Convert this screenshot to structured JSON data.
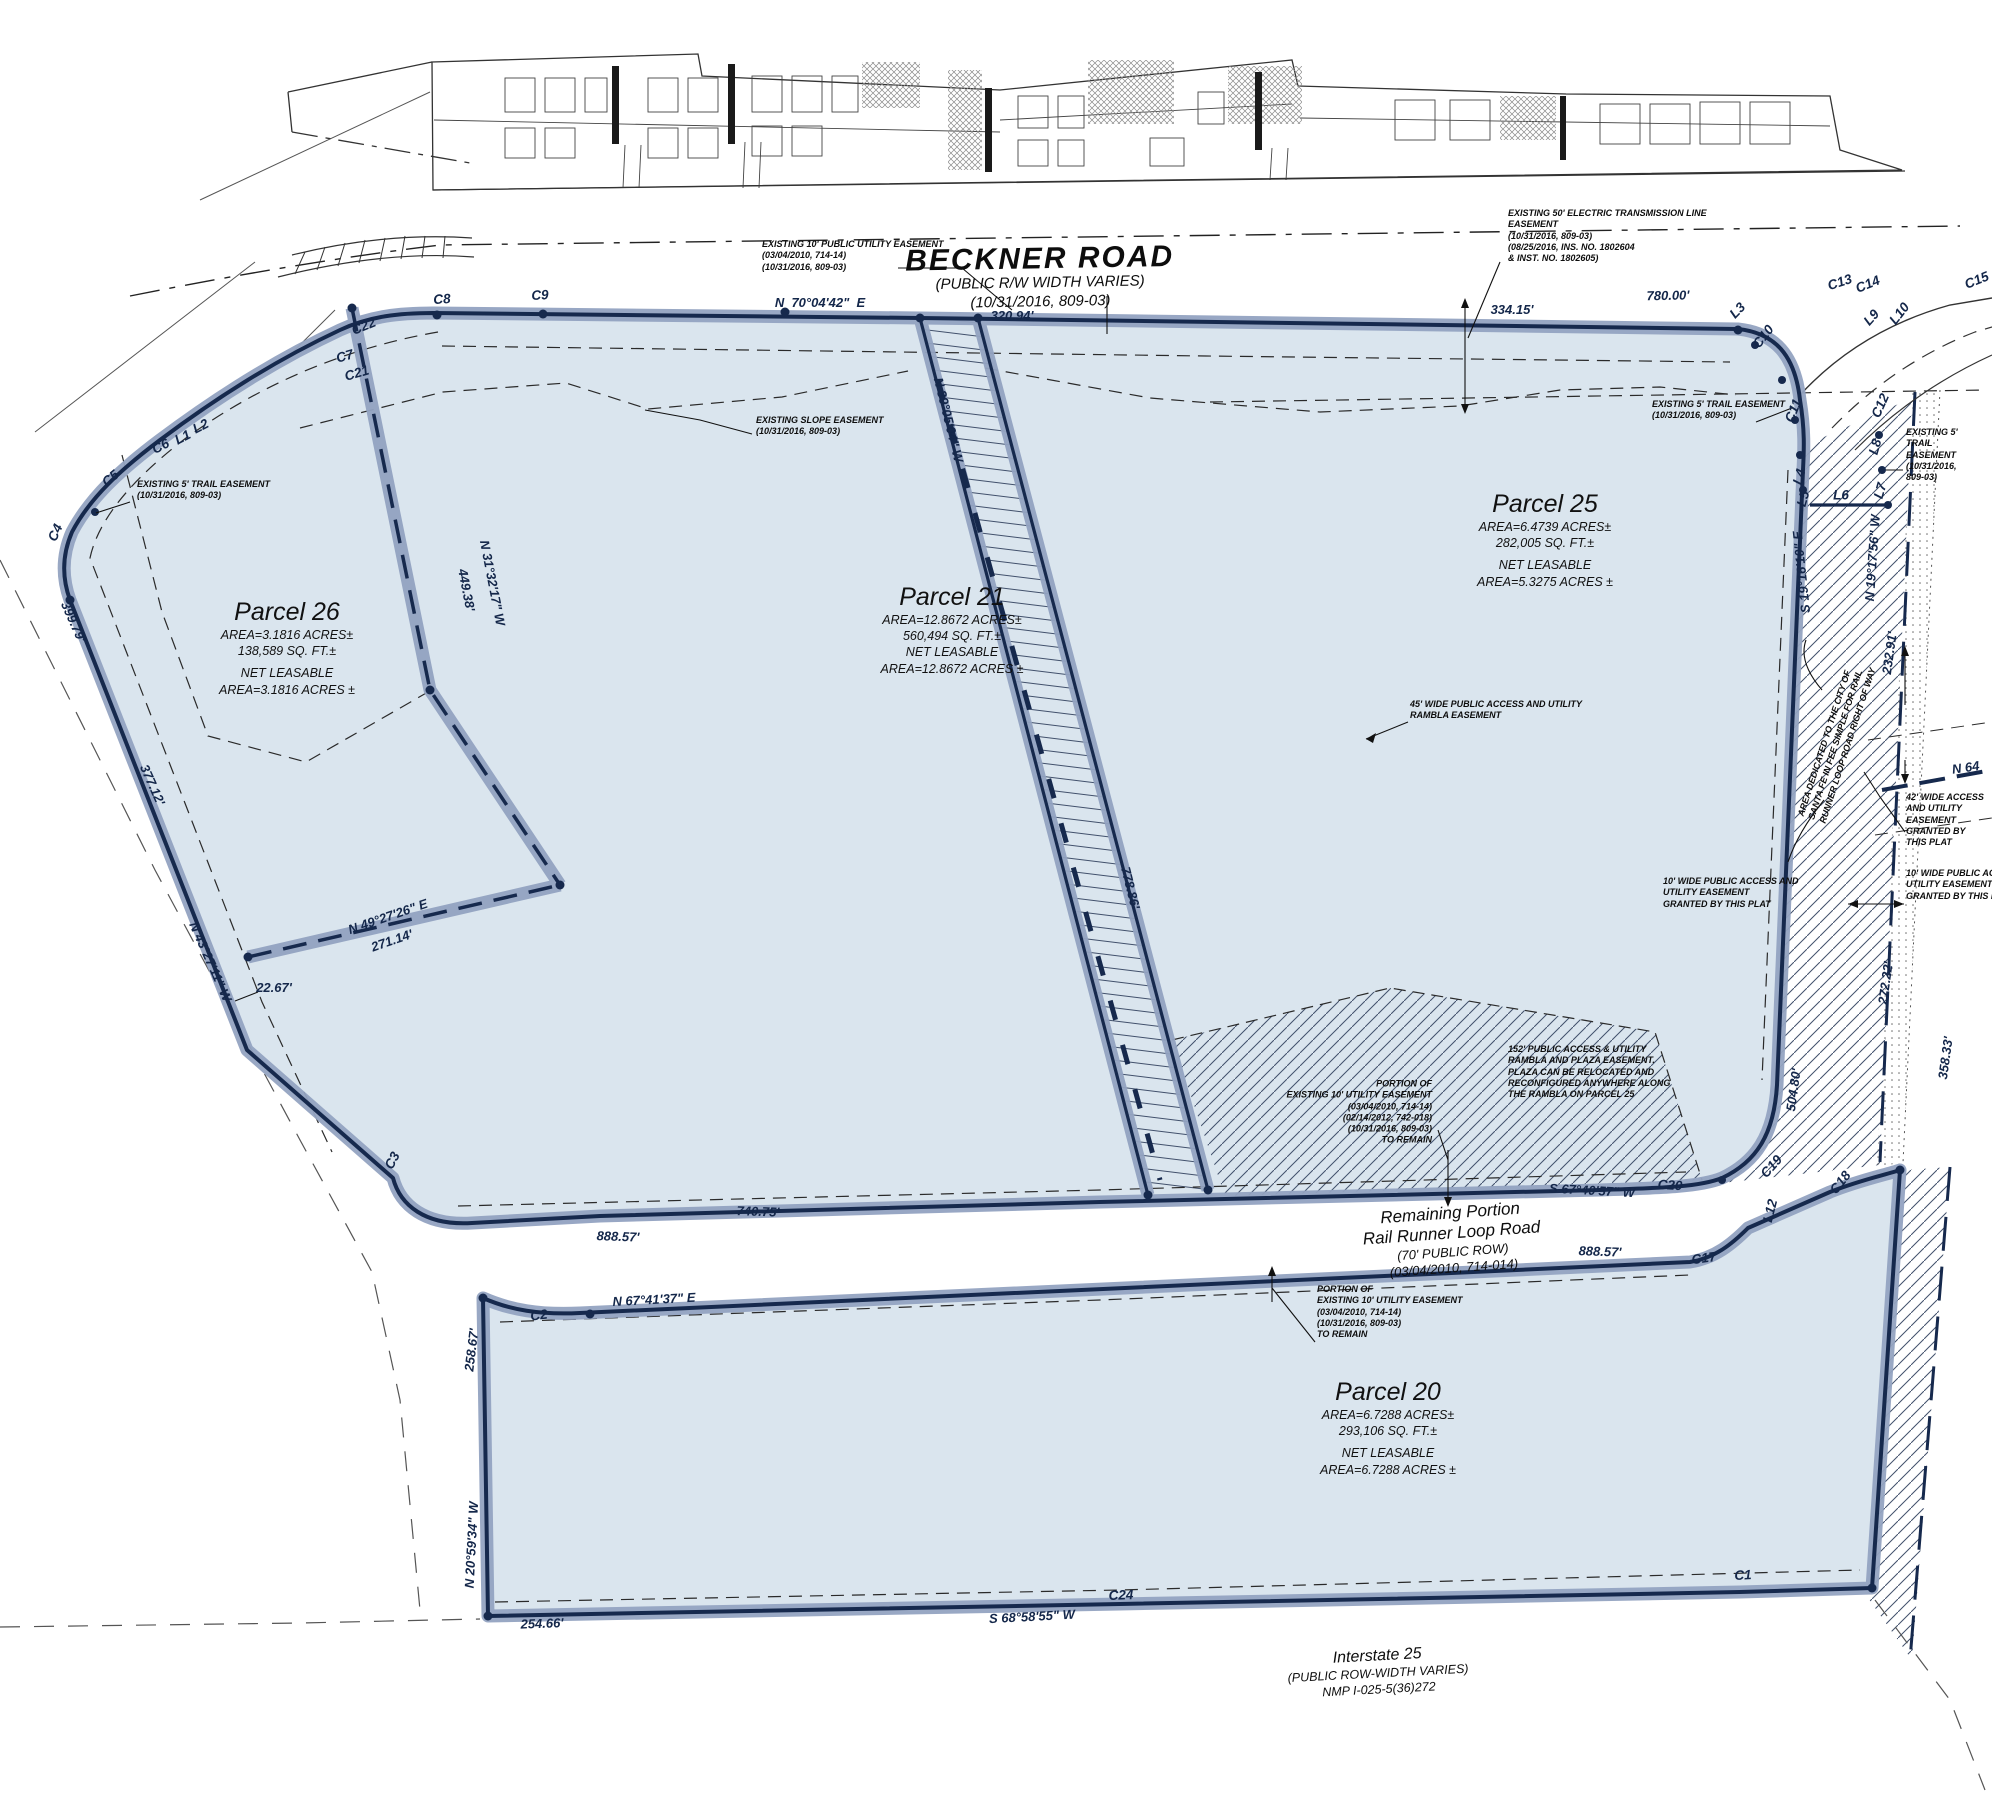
{
  "drawing_type": "subdivision plat map",
  "roads": {
    "beckner": {
      "name": "BECKNER ROAD",
      "sub1": "(PUBLIC R/W  WIDTH  VARIES)",
      "sub2": "(10/31/2016, 809-03)"
    },
    "rail_runner": {
      "line1": "Remaining Portion",
      "line2": "Rail Runner Loop Road",
      "sub1": "(70'  PUBLIC  ROW)",
      "sub2": "(03/04/2010,  714-014)"
    },
    "interstate": {
      "name": "Interstate 25",
      "sub1": "(PUBLIC ROW-WIDTH VARIES)",
      "sub2": "NMP I-025-5(36)272"
    }
  },
  "parcels": {
    "p26": {
      "title": "Parcel 26",
      "area": "AREA=3.1816  ACRES±",
      "sqft": "138,589  SQ.  FT.±",
      "net_label": "NET LEASABLE",
      "net_area": "AREA=3.1816  ACRES ±"
    },
    "p21": {
      "title": "Parcel 21",
      "area": "AREA=12.8672  ACRES±",
      "sqft": "560,494  SQ.  FT.±",
      "net_label": "NET LEASABLE",
      "net_area": "AREA=12.8672  ACRES ±"
    },
    "p25": {
      "title": "Parcel 25",
      "area": "AREA=6.4739  ACRES±",
      "sqft": "282,005  SQ.  FT.±",
      "net_label": "NET LEASABLE",
      "net_area": "AREA=5.3275  ACRES ±"
    },
    "p20": {
      "title": "Parcel 20",
      "area": "AREA=6.7288  ACRES±",
      "sqft": "293,106  SQ.  FT.±",
      "net_label": "NET LEASABLE",
      "net_area": "AREA=6.7288  ACRES ±"
    }
  },
  "colors": {
    "parcel_fill": "#dae5ee",
    "boundary_casing": "#93a3c1",
    "boundary_line": "#16294d",
    "note_text": "#0d0d0d"
  },
  "annotations": [
    {
      "name": "note-pue-beckner",
      "cls": "note",
      "align": "l",
      "x": 762,
      "y": 256,
      "rot": 0,
      "text": "EXISTING 10' PUBLIC UTILITY EASEMENT\n(03/04/2010, 714-14)\n(10/31/2016, 809-03)"
    },
    {
      "name": "note-electric-easement",
      "cls": "note",
      "align": "l",
      "x": 1508,
      "y": 236,
      "rot": 0,
      "text": "EXISTING 50' ELECTRIC TRANSMISSION LINE\nEASEMENT\n(10/31/2016, 809-03)\n(08/25/2016, INS. NO. 1802604\n& INST. NO. 1802605)"
    },
    {
      "name": "note-slope-easement",
      "cls": "note",
      "align": "l",
      "x": 756,
      "y": 426,
      "rot": 0,
      "text": "EXISTING SLOPE EASEMENT\n(10/31/2016, 809-03)"
    },
    {
      "name": "note-trail-easement-left",
      "cls": "note",
      "align": "l",
      "x": 137,
      "y": 490,
      "rot": 0,
      "text": "EXISTING 5' TRAIL EASEMENT\n(10/31/2016, 809-03)"
    },
    {
      "name": "note-trail-easement-right",
      "cls": "note",
      "align": "l",
      "x": 1652,
      "y": 410,
      "rot": 0,
      "text": "EXISTING 5' TRAIL EASEMENT\n(10/31/2016, 809-03)"
    },
    {
      "name": "note-trail-easement-right-2",
      "cls": "note",
      "align": "l",
      "x": 1906,
      "y": 455,
      "rot": 0,
      "text": "EXISTING 5'\nTRAIL\nEASEMENT\n(10/31/2016,\n809-03)"
    },
    {
      "name": "note-rambla-45",
      "cls": "note",
      "align": "l",
      "x": 1410,
      "y": 710,
      "rot": 0,
      "text": "45' WIDE PUBLIC ACCESS AND UTILITY\nRAMBLA EASEMENT"
    },
    {
      "name": "note-plaza-152",
      "cls": "note",
      "align": "l",
      "x": 1508,
      "y": 1072,
      "rot": 0,
      "text": "152' PUBLIC ACCESS & UTILITY\nRAMBLA AND PLAZA EASEMENT.\nPLAZA CAN BE RELOCATED AND\nRECONFIGURED ANYWHERE ALONG\nTHE RAMBLA ON PARCEL 25"
    },
    {
      "name": "note-10-access-and-utility",
      "cls": "note",
      "align": "l",
      "x": 1663,
      "y": 893,
      "rot": 0,
      "text": "10' WIDE PUBLIC ACCESS AND\nUTILITY EASEMENT\nGRANTED BY THIS PLAT"
    },
    {
      "name": "note-10-access-utility",
      "cls": "note",
      "align": "l",
      "x": 1906,
      "y": 885,
      "rot": 0,
      "text": "10' WIDE PUBLIC ACCESS\nUTILITY EASEMENT\nGRANTED BY THIS PLAT"
    },
    {
      "name": "note-42-access",
      "cls": "note",
      "align": "l",
      "x": 1906,
      "y": 820,
      "rot": 0,
      "text": "42' WIDE ACCESS\nAND UTILITY\nEASEMENT\nGRANTED BY\nTHIS PLAT"
    },
    {
      "name": "note-city-dedication",
      "cls": "note",
      "align": "c",
      "x": 1837,
      "y": 742,
      "rot": -72,
      "text": "AREA DEDICATED TO THE CITY OF\nSANTA FE IN FEE SIMPLE FOR RAIL\nRUNNER LOOP ROAD RIGHT OF WAY"
    },
    {
      "name": "note-portion-pue-mid",
      "cls": "note",
      "align": "r",
      "x": 1432,
      "y": 1112,
      "rot": 0,
      "text": "PORTION OF\nEXISTING 10' UTILITY EASEMENT\n(03/04/2010, 714-14)\n(02/14/2012, 742-018)\n(10/31/2016, 809-03)\nTO REMAIN"
    },
    {
      "name": "note-portion-pue-low",
      "cls": "note",
      "align": "l",
      "x": 1317,
      "y": 1312,
      "rot": 0,
      "text": "PORTION OF\nEXISTING 10' UTILITY EASEMENT\n(03/04/2010, 714-14)\n(10/31/2016, 809-03)\nTO REMAIN"
    },
    {
      "name": "bearing-beckner",
      "cls": "dim",
      "align": "c",
      "x": 820,
      "y": 303,
      "rot": 0,
      "text": "N  70°04'42\"  E"
    },
    {
      "name": "dim-320-94",
      "cls": "dim",
      "align": "c",
      "x": 1012,
      "y": 316,
      "rot": 0,
      "text": "320.94'"
    },
    {
      "name": "dim-334-15",
      "cls": "dim",
      "align": "c",
      "x": 1512,
      "y": 310,
      "rot": 0,
      "text": "334.15'"
    },
    {
      "name": "dim-780-00",
      "cls": "dim",
      "align": "c",
      "x": 1668,
      "y": 296,
      "rot": -1,
      "text": "780.00'"
    },
    {
      "name": "bearing-n31-32-17",
      "cls": "dim",
      "align": "c",
      "x": 492,
      "y": 583,
      "rot": 79,
      "text": "N 31°32'17\" W"
    },
    {
      "name": "dim-449-38",
      "cls": "dim",
      "align": "c",
      "x": 466,
      "y": 590,
      "rot": 79,
      "text": "449.38'"
    },
    {
      "name": "bearing-n39-05-04",
      "cls": "dim",
      "align": "c",
      "x": 948,
      "y": 420,
      "rot": 76,
      "text": "N 39°05'04\" W"
    },
    {
      "name": "dim-778-86",
      "cls": "dim",
      "align": "c",
      "x": 1130,
      "y": 888,
      "rot": 76,
      "text": "778.86'"
    },
    {
      "name": "bearing-s19-16-10",
      "cls": "dim",
      "align": "c",
      "x": 1802,
      "y": 572,
      "rot": -96,
      "text": "S 19°16'10\" E"
    },
    {
      "name": "bearing-n19-17-56",
      "cls": "dim",
      "align": "c",
      "x": 1873,
      "y": 558,
      "rot": -86,
      "text": "N 19°17'56\" W"
    },
    {
      "name": "dim-232-91",
      "cls": "dim",
      "align": "c",
      "x": 1890,
      "y": 653,
      "rot": -82,
      "text": "232.91'"
    },
    {
      "name": "dim-272-22",
      "cls": "dim",
      "align": "c",
      "x": 1886,
      "y": 983,
      "rot": -82,
      "text": "272.22'"
    },
    {
      "name": "dim-504-80",
      "cls": "dim",
      "align": "c",
      "x": 1794,
      "y": 1090,
      "rot": -82,
      "text": "504.80'"
    },
    {
      "name": "bearing-n64-partial",
      "cls": "dim",
      "align": "l",
      "x": 1952,
      "y": 768,
      "rot": -8,
      "text": "N 64"
    },
    {
      "name": "dim-399-79",
      "cls": "dim",
      "align": "c",
      "x": 73,
      "y": 622,
      "rot": 66,
      "text": "399.79'"
    },
    {
      "name": "dim-377-12",
      "cls": "dim",
      "align": "c",
      "x": 152,
      "y": 785,
      "rot": 66,
      "text": "377.12'"
    },
    {
      "name": "bearing-n43-27-11",
      "cls": "dim",
      "align": "c",
      "x": 210,
      "y": 962,
      "rot": 66,
      "text": "N 43°27'11\" W"
    },
    {
      "name": "dim-22-67",
      "cls": "dim",
      "align": "c",
      "x": 274,
      "y": 988,
      "rot": 0,
      "text": "22.67'"
    },
    {
      "name": "bearing-n49-27-26",
      "cls": "dim",
      "align": "c",
      "x": 388,
      "y": 917,
      "rot": -19,
      "text": "N 49°27'26\" E"
    },
    {
      "name": "dim-271-14",
      "cls": "dim",
      "align": "c",
      "x": 392,
      "y": 941,
      "rot": -19,
      "text": "271.14'"
    },
    {
      "name": "dim-888-57-a",
      "cls": "dim",
      "align": "c",
      "x": 618,
      "y": 1237,
      "rot": 2,
      "text": "888.57'"
    },
    {
      "name": "dim-740-75",
      "cls": "dim",
      "align": "c",
      "x": 758,
      "y": 1212,
      "rot": 2,
      "text": "740.75'"
    },
    {
      "name": "bearing-s67-40-57",
      "cls": "dim",
      "align": "c",
      "x": 1592,
      "y": 1191,
      "rot": 3,
      "text": "S 67°40'57\" W"
    },
    {
      "name": "dim-888-57-b",
      "cls": "dim",
      "align": "c",
      "x": 1600,
      "y": 1252,
      "rot": 2,
      "text": "888.57'"
    },
    {
      "name": "bearing-n67-41-37",
      "cls": "dim",
      "align": "c",
      "x": 654,
      "y": 1300,
      "rot": -3,
      "text": "N 67°41'37\" E"
    },
    {
      "name": "dim-258-67",
      "cls": "dim",
      "align": "c",
      "x": 472,
      "y": 1350,
      "rot": -83,
      "text": "258.67'"
    },
    {
      "name": "bearing-n20-59-34",
      "cls": "dim",
      "align": "c",
      "x": 472,
      "y": 1545,
      "rot": -87,
      "text": "N 20°59'34\" W"
    },
    {
      "name": "dim-254-66",
      "cls": "dim",
      "align": "c",
      "x": 542,
      "y": 1624,
      "rot": -2,
      "text": "254.66'"
    },
    {
      "name": "bearing-s68-58-55",
      "cls": "dim",
      "align": "c",
      "x": 1032,
      "y": 1617,
      "rot": -3,
      "text": "S 68°58'55\" W"
    },
    {
      "name": "dim-358-33",
      "cls": "dim",
      "align": "c",
      "x": 1946,
      "y": 1058,
      "rot": -82,
      "text": "358.33'"
    },
    {
      "name": "curve-c8",
      "cls": "curve",
      "align": "c",
      "x": 442,
      "y": 300,
      "rot": -4,
      "text": "C8"
    },
    {
      "name": "curve-c9",
      "cls": "curve",
      "align": "c",
      "x": 540,
      "y": 296,
      "rot": -3,
      "text": "C9"
    },
    {
      "name": "curve-c22",
      "cls": "curve",
      "align": "c",
      "x": 364,
      "y": 327,
      "rot": -22,
      "text": "C22"
    },
    {
      "name": "curve-c7",
      "cls": "curve",
      "align": "c",
      "x": 345,
      "y": 357,
      "rot": -16,
      "text": "C7"
    },
    {
      "name": "curve-c21",
      "cls": "curve",
      "align": "c",
      "x": 357,
      "y": 374,
      "rot": -16,
      "text": "C21"
    },
    {
      "name": "curve-c6",
      "cls": "curve",
      "align": "c",
      "x": 161,
      "y": 447,
      "rot": -27,
      "text": "C6"
    },
    {
      "name": "line-l1",
      "cls": "curve",
      "align": "c",
      "x": 183,
      "y": 438,
      "rot": -27,
      "text": "L1"
    },
    {
      "name": "line-l2",
      "cls": "curve",
      "align": "c",
      "x": 201,
      "y": 427,
      "rot": -27,
      "text": "L2"
    },
    {
      "name": "curve-c5",
      "cls": "curve",
      "align": "c",
      "x": 111,
      "y": 479,
      "rot": -40,
      "text": "C5"
    },
    {
      "name": "curve-c4",
      "cls": "curve",
      "align": "c",
      "x": 56,
      "y": 533,
      "rot": -66,
      "text": "C4"
    },
    {
      "name": "curve-c3",
      "cls": "curve",
      "align": "c",
      "x": 393,
      "y": 1161,
      "rot": -62,
      "text": "C3"
    },
    {
      "name": "line-l3",
      "cls": "curve",
      "align": "c",
      "x": 1738,
      "y": 311,
      "rot": -46,
      "text": "L3"
    },
    {
      "name": "curve-c10",
      "cls": "curve",
      "align": "c",
      "x": 1764,
      "y": 337,
      "rot": -52,
      "text": "C10"
    },
    {
      "name": "curve-c11",
      "cls": "curve",
      "align": "c",
      "x": 1794,
      "y": 411,
      "rot": -68,
      "text": "C11"
    },
    {
      "name": "line-l4",
      "cls": "curve",
      "align": "c",
      "x": 1800,
      "y": 477,
      "rot": -74,
      "text": "L4"
    },
    {
      "name": "line-l5",
      "cls": "curve",
      "align": "c",
      "x": 1804,
      "y": 499,
      "rot": -74,
      "text": "L5"
    },
    {
      "name": "line-l6",
      "cls": "curve",
      "align": "c",
      "x": 1841,
      "y": 496,
      "rot": 0,
      "text": "L6"
    },
    {
      "name": "line-l7",
      "cls": "curve",
      "align": "c",
      "x": 1881,
      "y": 491,
      "rot": -74,
      "text": "L7"
    },
    {
      "name": "line-l8",
      "cls": "curve",
      "align": "c",
      "x": 1876,
      "y": 447,
      "rot": -74,
      "text": "L8"
    },
    {
      "name": "curve-c12",
      "cls": "curve",
      "align": "c",
      "x": 1881,
      "y": 406,
      "rot": -66,
      "text": "C12"
    },
    {
      "name": "curve-c13",
      "cls": "curve",
      "align": "c",
      "x": 1840,
      "y": 283,
      "rot": -18,
      "text": "C13"
    },
    {
      "name": "curve-c14",
      "cls": "curve",
      "align": "c",
      "x": 1868,
      "y": 285,
      "rot": -22,
      "text": "C14"
    },
    {
      "name": "curve-c15",
      "cls": "curve",
      "align": "c",
      "x": 1977,
      "y": 281,
      "rot": -22,
      "text": "C15"
    },
    {
      "name": "line-l9",
      "cls": "curve",
      "align": "c",
      "x": 1872,
      "y": 318,
      "rot": -48,
      "text": "L9"
    },
    {
      "name": "line-l10",
      "cls": "curve",
      "align": "c",
      "x": 1900,
      "y": 314,
      "rot": -52,
      "text": "L10"
    },
    {
      "name": "curve-c2",
      "cls": "curve",
      "align": "c",
      "x": 539,
      "y": 1316,
      "rot": -7,
      "text": "C2"
    },
    {
      "name": "curve-c20",
      "cls": "curve",
      "align": "c",
      "x": 1670,
      "y": 1186,
      "rot": 3,
      "text": "C20"
    },
    {
      "name": "curve-c19",
      "cls": "curve",
      "align": "c",
      "x": 1772,
      "y": 1167,
      "rot": -48,
      "text": "C19"
    },
    {
      "name": "curve-c17",
      "cls": "curve",
      "align": "c",
      "x": 1704,
      "y": 1259,
      "rot": -8,
      "text": "C17"
    },
    {
      "name": "line-l12",
      "cls": "curve",
      "align": "c",
      "x": 1771,
      "y": 1211,
      "rot": -76,
      "text": "L12"
    },
    {
      "name": "curve-c18",
      "cls": "curve",
      "align": "c",
      "x": 1841,
      "y": 1183,
      "rot": -52,
      "text": "C18"
    },
    {
      "name": "curve-c24",
      "cls": "curve",
      "align": "c",
      "x": 1121,
      "y": 1596,
      "rot": -2,
      "text": "C24"
    },
    {
      "name": "curve-c1",
      "cls": "curve",
      "align": "c",
      "x": 1743,
      "y": 1576,
      "rot": -3,
      "text": "C1"
    }
  ]
}
